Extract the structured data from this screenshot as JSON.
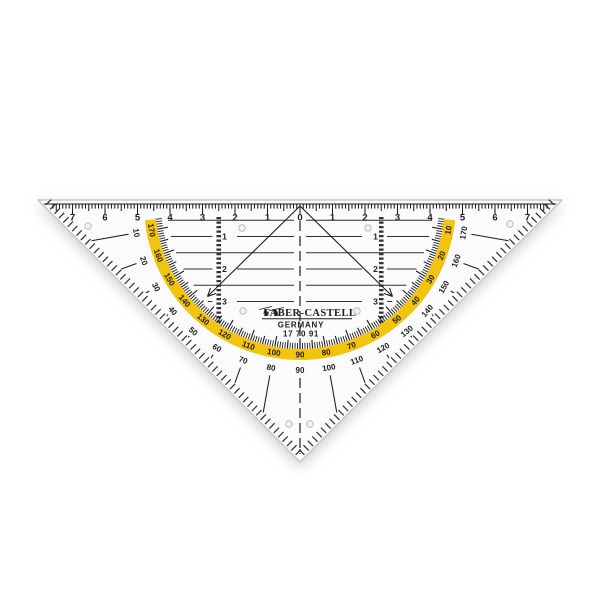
{
  "product": {
    "brand": "FABER-CASTELL",
    "origin": "GERMANY",
    "article_number": "17 70 91",
    "logo_icon": "jousting-knights-icon",
    "logo_glyph": "♞"
  },
  "ruler_scale": {
    "unit": "cm",
    "labels": [
      "7",
      "6",
      "5",
      "4",
      "3",
      "2",
      "1",
      "0",
      "1",
      "2",
      "3",
      "4",
      "5",
      "6",
      "7"
    ]
  },
  "protractor": {
    "outer_scale_degrees": [
      10,
      20,
      30,
      40,
      50,
      60,
      70,
      80,
      90,
      100,
      110,
      120,
      130,
      140,
      150,
      160,
      170
    ],
    "inner_scale_degrees": [
      170,
      160,
      150,
      140,
      130,
      120,
      110,
      100,
      90,
      80,
      70,
      60,
      50,
      40,
      30,
      20,
      10
    ]
  },
  "depth_scale_labels": [
    "1",
    "2",
    "3"
  ],
  "colors": {
    "band": "#F2C40E",
    "ink": "#1d1d1f",
    "line": "#333333",
    "plastic": "#fbfbfd",
    "edge": "#c7c9ce",
    "hole_stroke": "#b9bcc2",
    "hole_fill": "#f2f3f5"
  }
}
